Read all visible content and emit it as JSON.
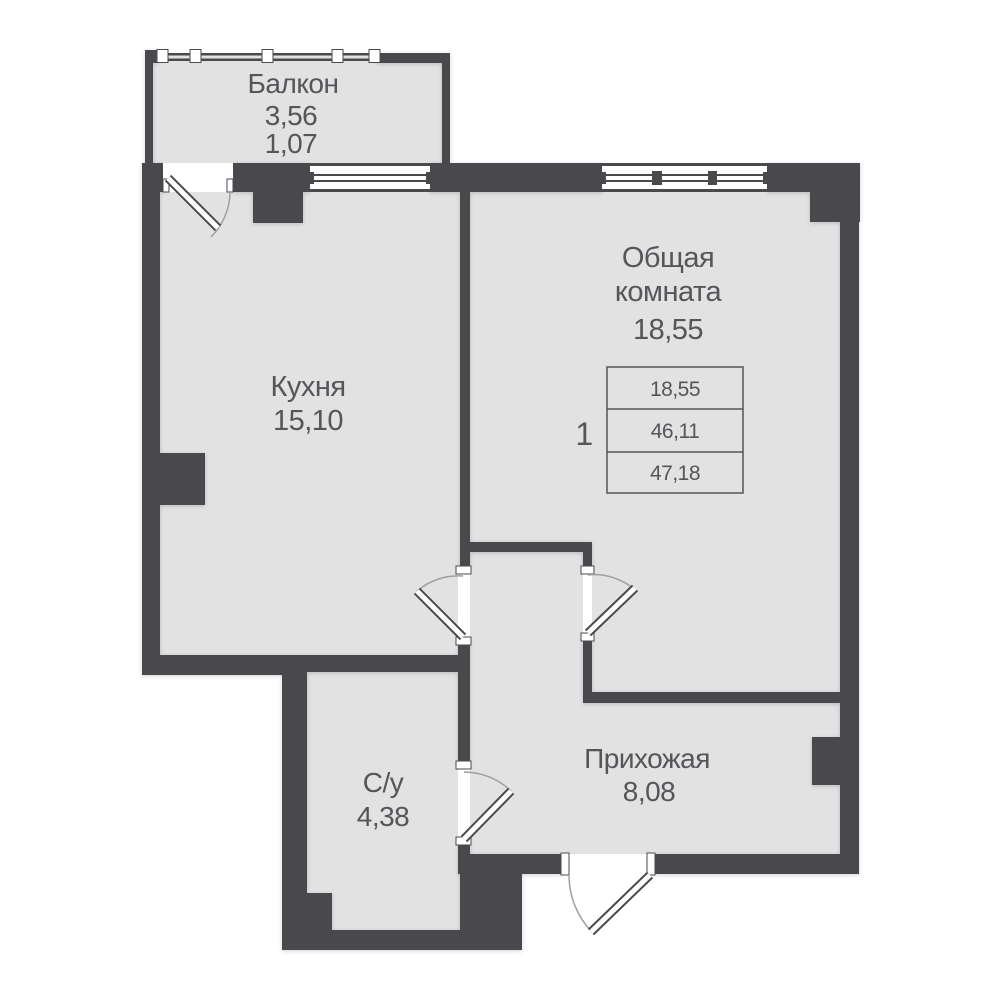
{
  "rooms": {
    "balcony": {
      "name": "Балкон",
      "area_total": "3,56",
      "area_reduced": "1,07"
    },
    "kitchen": {
      "name": "Кухня",
      "area": "15,10"
    },
    "living": {
      "name_line1": "Общая",
      "name_line2": "комната",
      "area": "18,55"
    },
    "hallway": {
      "name": "Прихожая",
      "area": "8,08"
    },
    "bathroom": {
      "name": "С/у",
      "area": "4,38"
    }
  },
  "info_table": {
    "rooms_count": "1",
    "rows": [
      "18,55",
      "46,11",
      "47,18"
    ]
  },
  "colors": {
    "wall": "#4a4a4d",
    "floor": "#e2e2e3",
    "text": "#55555a",
    "background": "#ffffff"
  }
}
